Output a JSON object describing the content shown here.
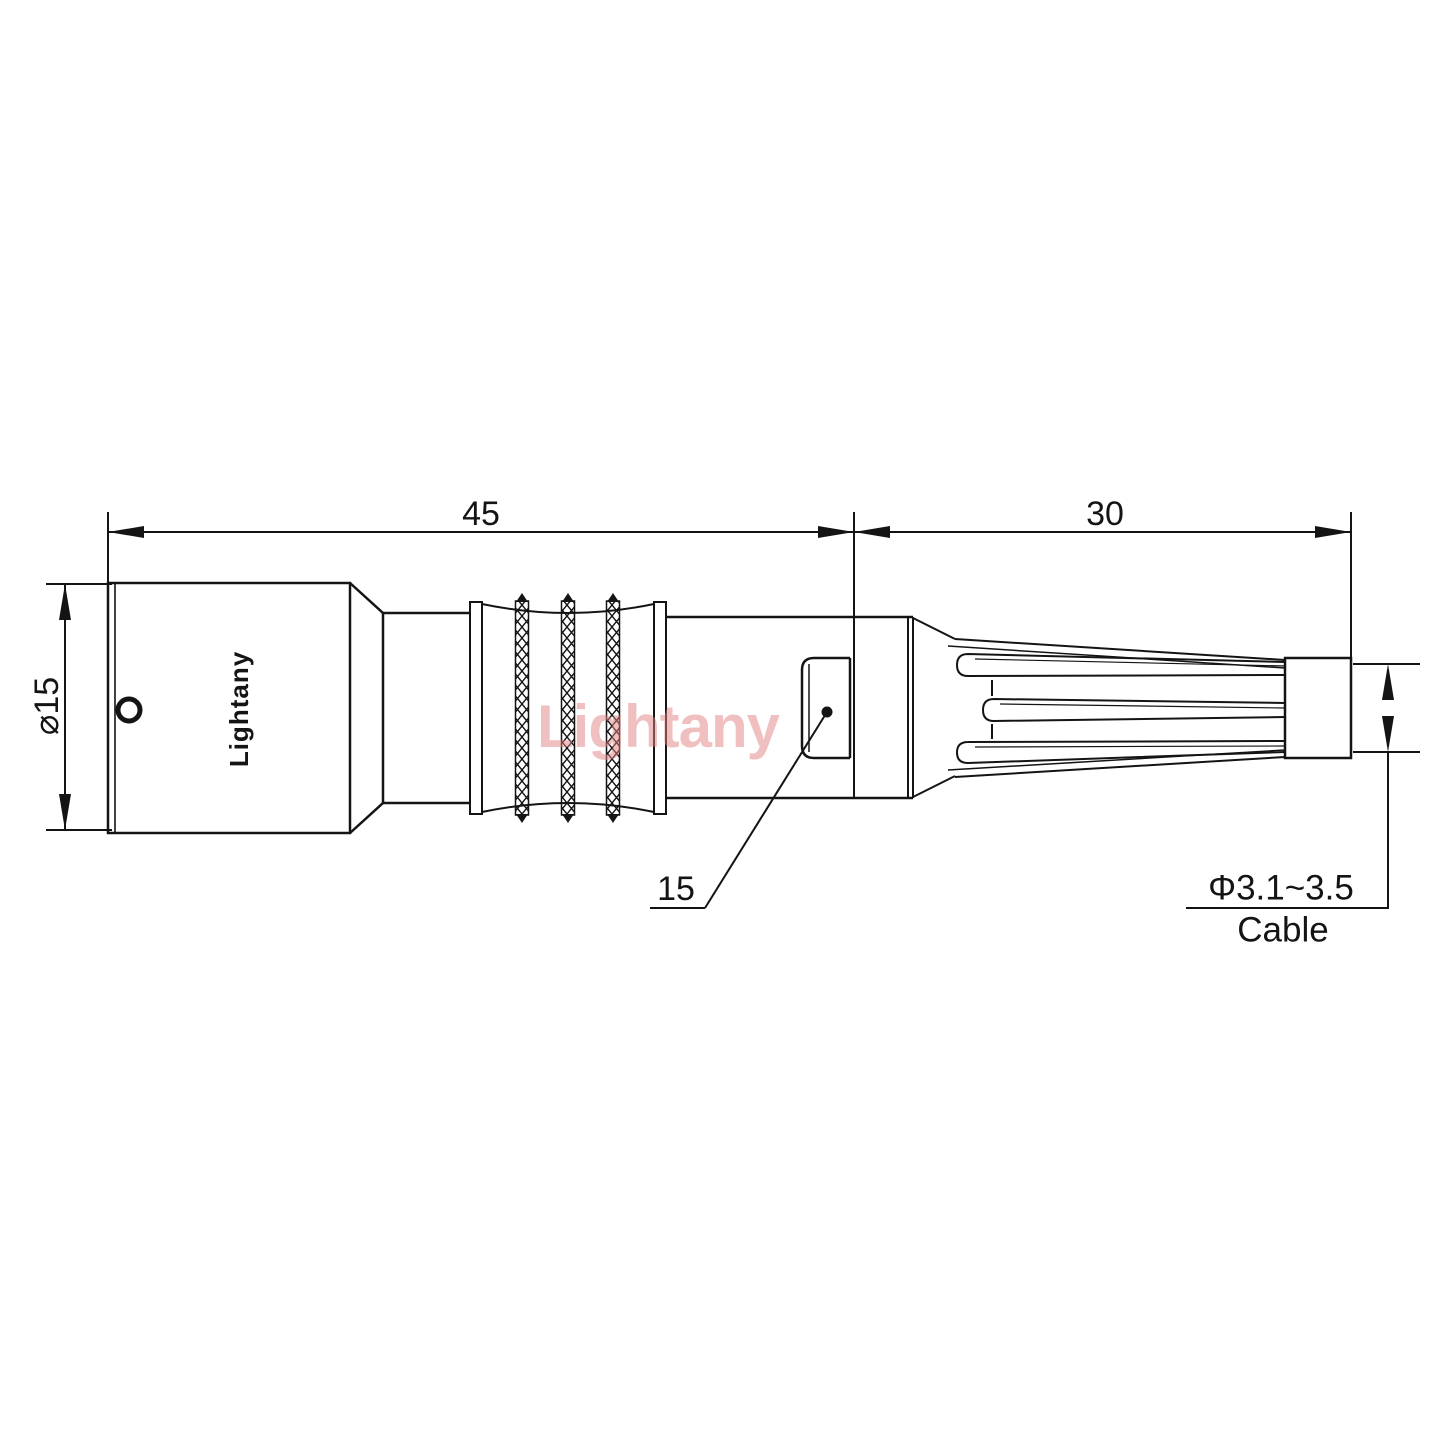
{
  "drawing": {
    "brand_label": "Lightany",
    "watermark": "Lightany",
    "dimensions": {
      "overall_length": "45",
      "boot_length": "30",
      "body_diameter": "⌀15",
      "latch_size": "15",
      "cable_diameter": "Φ3.1~3.5",
      "cable_label": "Cable"
    },
    "colors": {
      "line": "#141414",
      "watermark": "#e28282",
      "background": "#ffffff"
    }
  }
}
